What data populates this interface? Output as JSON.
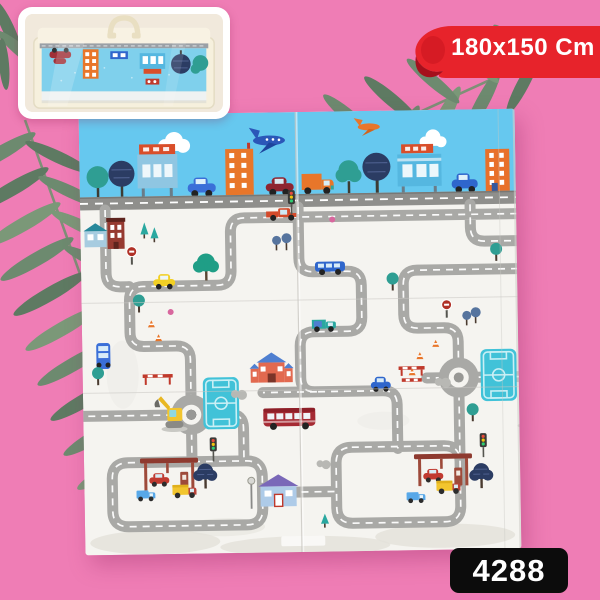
{
  "page": {
    "type": "product-photo",
    "background_color": "#ef7db5"
  },
  "size_ribbon": {
    "label": "180x150 Cm",
    "bg_color": "#e7232b",
    "fold_color": "#a50f1c",
    "text_color": "#ffffff"
  },
  "product_code_badge": {
    "label": "4288",
    "bg_color": "#0c0c0c",
    "text_color": "#ffffff"
  },
  "inset_thumbnail": {
    "frame_color": "#ffffff",
    "content": "folded-playmat-in-clear-carry-bag",
    "bag_color": "#f6f0dd",
    "mat_band_color": "#7fd0ec"
  },
  "playmat": {
    "theme": "city-roads-kids-playmat",
    "base_color": "#f5f4f0",
    "sky_color": "#66c8ef",
    "road_color": "#a9a9a6",
    "border_road_color": "#8f8f8c",
    "field_color": "#41c2d8",
    "elements": [
      "clouds",
      "airplanes",
      "shop-buildings",
      "tower-buildings",
      "teal-trees",
      "navy-trees",
      "cars",
      "pickup-truck",
      "vans",
      "box-trucks",
      "red-bus",
      "roundabouts",
      "soccer-fields",
      "gas-stations",
      "excavators",
      "traffic-lights",
      "stop-signs",
      "houses",
      "school",
      "traffic-cones",
      "barriers",
      "street-lamp"
    ]
  },
  "decor": {
    "palm_fronds": 2,
    "palm_color": "#6e8a70"
  }
}
